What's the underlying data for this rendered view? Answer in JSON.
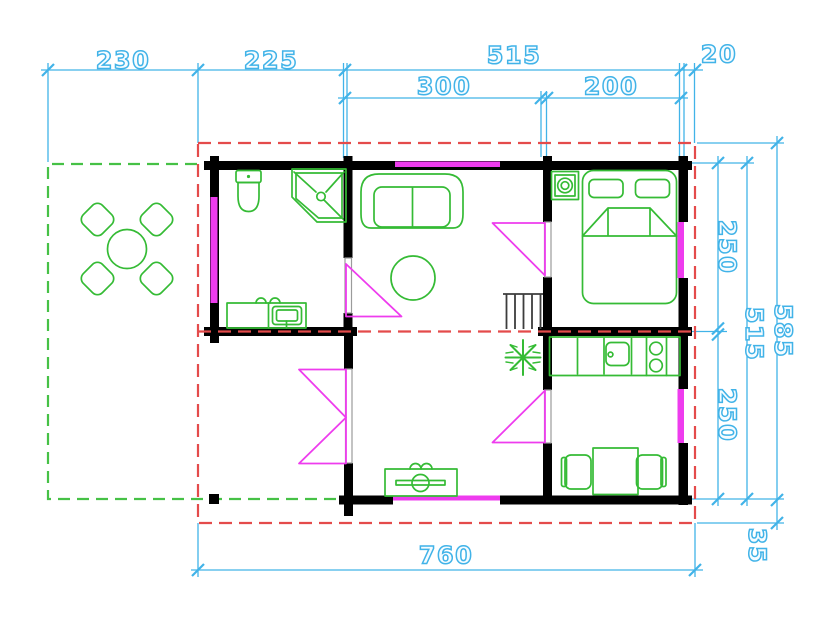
{
  "colors": {
    "dimension_lines": "#41b3e8",
    "walls": "#000000",
    "furniture": "#35bb35",
    "terrace_outline": "#46c146",
    "openings": "#ee3cee",
    "roof_outline": "#e44b4b",
    "door_jamb": "#9b9b9b",
    "stairs": "#3d3d3d",
    "background": "#ffffff"
  },
  "dimensions_cm": {
    "terrace_width": "230",
    "bathroom_width": "225",
    "living_bedroom_width": "515",
    "right_overhang": "20",
    "living_width": "300",
    "bedroom_width": "200",
    "bedroom_depth": "250",
    "kitchen_depth": "250",
    "interior_depth": "515",
    "roof_depth": "585",
    "total_width": "760",
    "eaves_overhang": "35"
  }
}
